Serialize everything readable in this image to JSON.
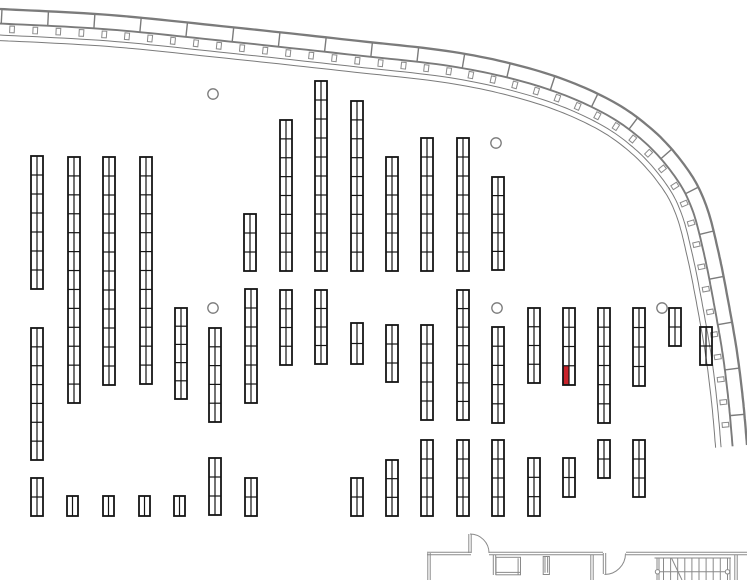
{
  "plan": {
    "width": 747,
    "height": 580,
    "colors": {
      "background": "#ffffff",
      "shelf_line": "#141414",
      "highlight": "#c9232b",
      "facade": "#7b7b7b",
      "detail": "#8a8a8a"
    },
    "facade_curve": {
      "points": [
        [
          0,
          9
        ],
        [
          110,
          15
        ],
        [
          230,
          27
        ],
        [
          350,
          40
        ],
        [
          460,
          53
        ],
        [
          545,
          73
        ],
        [
          610,
          100
        ],
        [
          655,
          132
        ],
        [
          688,
          170
        ],
        [
          706,
          205
        ],
        [
          718,
          250
        ],
        [
          728,
          300
        ],
        [
          737,
          352
        ],
        [
          743,
          400
        ],
        [
          747,
          445
        ]
      ],
      "band_offset": 14.5,
      "rail_offsets": [
        26,
        31.5
      ],
      "tick_offset": 19.8,
      "mullion_spacing": 46.5,
      "tick_spacing": 23.2
    },
    "columns": {
      "radius": 5.2,
      "centers": [
        [
          213,
          94
        ],
        [
          496,
          143
        ],
        [
          213,
          308
        ],
        [
          497,
          308
        ],
        [
          662,
          308
        ]
      ]
    },
    "shelves": [
      {
        "x": 31,
        "y": 156,
        "w": 12,
        "h": 133,
        "rows": 7
      },
      {
        "x": 31,
        "y": 328,
        "w": 12,
        "h": 132,
        "rows": 7
      },
      {
        "x": 31,
        "y": 478,
        "w": 12,
        "h": 38,
        "rows": 2
      },
      {
        "x": 68,
        "y": 157,
        "w": 12,
        "h": 246,
        "rows": 13
      },
      {
        "x": 67,
        "y": 496,
        "w": 11,
        "h": 20,
        "rows": 1
      },
      {
        "x": 103,
        "y": 157,
        "w": 12,
        "h": 228,
        "rows": 12
      },
      {
        "x": 103,
        "y": 496,
        "w": 11,
        "h": 20,
        "rows": 1
      },
      {
        "x": 140,
        "y": 157,
        "w": 12,
        "h": 227,
        "rows": 12
      },
      {
        "x": 139,
        "y": 496,
        "w": 11,
        "h": 20,
        "rows": 1
      },
      {
        "x": 175,
        "y": 308,
        "w": 12,
        "h": 91,
        "rows": 5
      },
      {
        "x": 174,
        "y": 496,
        "w": 11,
        "h": 20,
        "rows": 1
      },
      {
        "x": 209,
        "y": 328,
        "w": 12,
        "h": 94,
        "rows": 5
      },
      {
        "x": 209,
        "y": 458,
        "w": 12,
        "h": 57,
        "rows": 3
      },
      {
        "x": 244,
        "y": 214,
        "w": 12,
        "h": 57,
        "rows": 3
      },
      {
        "x": 245,
        "y": 289,
        "w": 12,
        "h": 114,
        "rows": 6
      },
      {
        "x": 245,
        "y": 478,
        "w": 12,
        "h": 38,
        "rows": 2
      },
      {
        "x": 280,
        "y": 120,
        "w": 12,
        "h": 151,
        "rows": 8
      },
      {
        "x": 280,
        "y": 290,
        "w": 12,
        "h": 75,
        "rows": 4
      },
      {
        "x": 315,
        "y": 81,
        "w": 12,
        "h": 190,
        "rows": 10
      },
      {
        "x": 315,
        "y": 290,
        "w": 12,
        "h": 74,
        "rows": 4
      },
      {
        "x": 351,
        "y": 101,
        "w": 12,
        "h": 170,
        "rows": 9
      },
      {
        "x": 351,
        "y": 323,
        "w": 12,
        "h": 41,
        "rows": 2
      },
      {
        "x": 351,
        "y": 478,
        "w": 12,
        "h": 38,
        "rows": 2
      },
      {
        "x": 386,
        "y": 157,
        "w": 12,
        "h": 114,
        "rows": 6
      },
      {
        "x": 386,
        "y": 325,
        "w": 12,
        "h": 57,
        "rows": 3
      },
      {
        "x": 386,
        "y": 460,
        "w": 12,
        "h": 56,
        "rows": 3
      },
      {
        "x": 421,
        "y": 138,
        "w": 12,
        "h": 133,
        "rows": 7
      },
      {
        "x": 421,
        "y": 325,
        "w": 12,
        "h": 95,
        "rows": 5
      },
      {
        "x": 421,
        "y": 440,
        "w": 12,
        "h": 76,
        "rows": 4
      },
      {
        "x": 457,
        "y": 138,
        "w": 12,
        "h": 133,
        "rows": 7
      },
      {
        "x": 457,
        "y": 290,
        "w": 12,
        "h": 130,
        "rows": 7
      },
      {
        "x": 457,
        "y": 440,
        "w": 12,
        "h": 76,
        "rows": 4
      },
      {
        "x": 492,
        "y": 177,
        "w": 12,
        "h": 93,
        "rows": 5
      },
      {
        "x": 492,
        "y": 327,
        "w": 12,
        "h": 96,
        "rows": 5
      },
      {
        "x": 492,
        "y": 440,
        "w": 12,
        "h": 76,
        "rows": 4
      },
      {
        "x": 528,
        "y": 308,
        "w": 12,
        "h": 75,
        "rows": 4
      },
      {
        "x": 528,
        "y": 458,
        "w": 12,
        "h": 58,
        "rows": 3
      },
      {
        "x": 563,
        "y": 308,
        "w": 12,
        "h": 77,
        "rows": 4
      },
      {
        "x": 563,
        "y": 458,
        "w": 12,
        "h": 39,
        "rows": 2
      },
      {
        "x": 598,
        "y": 308,
        "w": 12,
        "h": 115,
        "rows": 6
      },
      {
        "x": 598,
        "y": 440,
        "w": 12,
        "h": 38,
        "rows": 2
      },
      {
        "x": 633,
        "y": 308,
        "w": 12,
        "h": 78,
        "rows": 4
      },
      {
        "x": 633,
        "y": 440,
        "w": 12,
        "h": 57,
        "rows": 3
      },
      {
        "x": 669,
        "y": 308,
        "w": 12,
        "h": 38,
        "rows": 2
      },
      {
        "x": 700,
        "y": 327,
        "w": 12,
        "h": 38,
        "rows": 2
      }
    ],
    "highlight": {
      "shelf": 37,
      "row": 3,
      "col": 0
    },
    "rooms": {
      "double_walls": [
        [
          427,
          553.5,
          471,
          553.5
        ],
        [
          489,
          553.5,
          603,
          553.5
        ],
        [
          626,
          553.5,
          747,
          553.5
        ],
        [
          429,
          553,
          429,
          580
        ],
        [
          494.5,
          555,
          494.5,
          575
        ],
        [
          592,
          555,
          592,
          580
        ],
        [
          736,
          555,
          736,
          580
        ],
        [
          470,
          534,
          470,
          553
        ],
        [
          604.5,
          553,
          604.5,
          574
        ]
      ],
      "door_arcs": [
        "M470,534 A19,19 0 0 1 489,553",
        "M604.5,574.5 A21,21 0 0 0 625.5,553.5"
      ],
      "counter": {
        "x": 496,
        "y": 557.3,
        "w": 24.5,
        "h": 17.5
      },
      "stub": {
        "x": 543.2,
        "y": 556.5,
        "w": 6.2,
        "h": 18
      },
      "stairs": {
        "x1": 657,
        "x2": 730,
        "top": 558,
        "bottom": 580,
        "tread_step": 7.1,
        "mid_y": 571.8,
        "end_r": 2.2,
        "diag": [
          671.5,
          558,
          682,
          580
        ]
      }
    }
  }
}
